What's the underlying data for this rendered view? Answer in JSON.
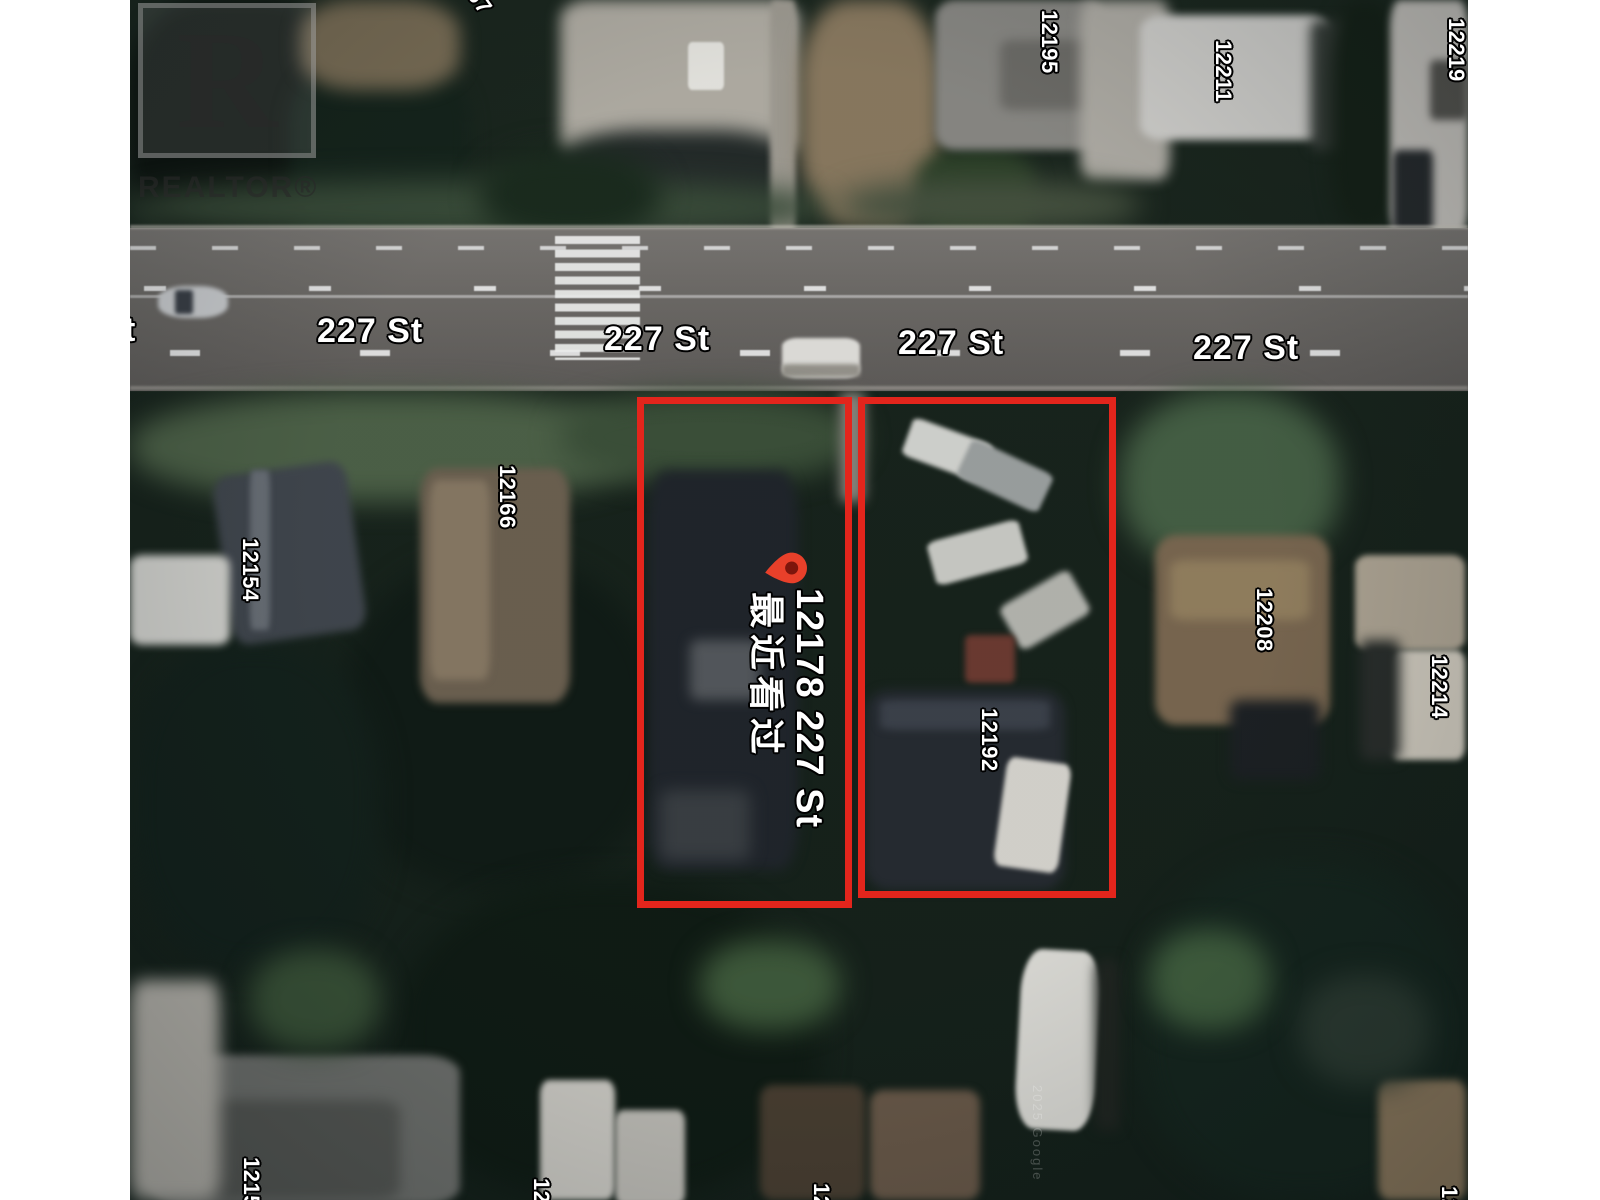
{
  "watermark": {
    "monogram": "R",
    "label": "REALTOR®"
  },
  "street": {
    "labels": [
      {
        "text": "227 St"
      },
      {
        "text": "227 St"
      },
      {
        "text": "227 St"
      },
      {
        "text": "227 St"
      }
    ],
    "partial_left": "t"
  },
  "marker": {
    "address": "12178 227 St",
    "status_zh": "最近看过"
  },
  "house_numbers": [
    {
      "text": "67",
      "partial": true
    },
    {
      "text": "12195"
    },
    {
      "text": "12211"
    },
    {
      "text": "12219"
    },
    {
      "text": "12166"
    },
    {
      "text": "12154"
    },
    {
      "text": "12192"
    },
    {
      "text": "12208"
    },
    {
      "text": "12214"
    },
    {
      "text": "12153",
      "partial": true
    },
    {
      "text": "12",
      "partial": true
    },
    {
      "text": "12",
      "partial": true
    },
    {
      "text": "12",
      "partial": true
    }
  ],
  "map_credit": "2025 Google",
  "colors": {
    "parcel_outline": "#e3251c",
    "pin": "#e8402a",
    "pin_core": "#7c150c",
    "label_text": "#ffffff",
    "label_outline": "#000000",
    "page_margin": "#ffffff"
  }
}
